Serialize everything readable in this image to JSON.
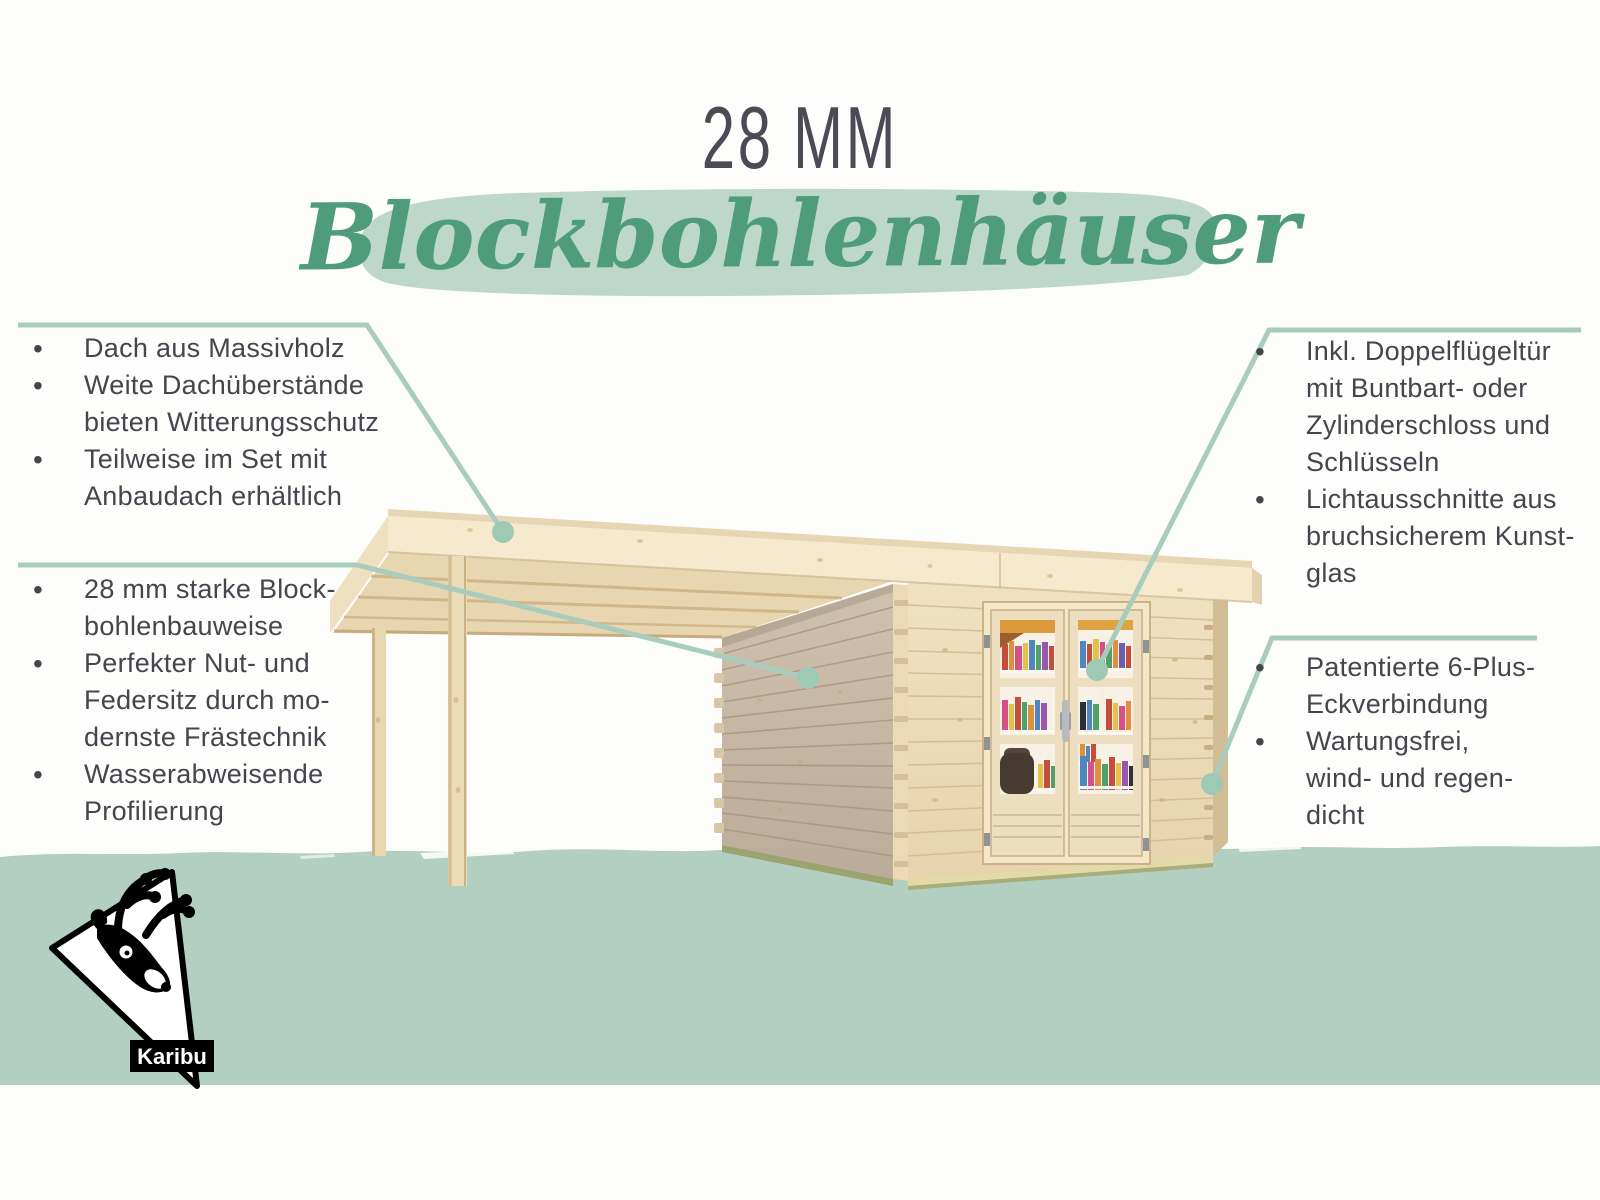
{
  "header": {
    "size_label": "28 MM",
    "title": "Blockbohlenhäuser"
  },
  "features": {
    "left_top": {
      "items": [
        {
          "lines": [
            "Dach aus Massivholz"
          ]
        },
        {
          "lines": [
            "Weite Dachüberstände",
            "bieten Witterungsschutz"
          ]
        },
        {
          "lines": [
            "Teilweise im Set mit",
            "Anbaudach erhältlich"
          ]
        }
      ]
    },
    "left_bottom": {
      "items": [
        {
          "lines": [
            "28 mm starke Block-",
            "bohlenbauweise"
          ]
        },
        {
          "lines": [
            "Perfekter Nut- und",
            "Federsitz durch mo-",
            "dernste Frästechnik"
          ]
        },
        {
          "lines": [
            "Wasserabweisende",
            "Profilierung"
          ]
        }
      ]
    },
    "right_top": {
      "items": [
        {
          "lines": [
            "Inkl. Doppelflügeltür",
            "mit Buntbart- oder",
            "Zylinderschloss und",
            "Schlüsseln"
          ]
        },
        {
          "lines": [
            "Lichtausschnitte aus",
            "bruchsicherem Kunst-",
            "glas"
          ]
        }
      ]
    },
    "right_bottom": {
      "items": [
        {
          "lines": [
            "Patentierte 6-Plus-",
            "Eckverbindung"
          ]
        },
        {
          "lines": [
            "Wartungsfrei,",
            "wind- und regen-",
            "dicht"
          ]
        }
      ]
    }
  },
  "logo": {
    "brand": "Karibu"
  },
  "colors": {
    "accent_green": "#4f9c7d",
    "brush_mint": "#bdd8ca",
    "ground_mint": "#b3cfc1",
    "callout_line": "#a9cdbd",
    "text": "#45454d",
    "roof_cream": "#f6e9cd",
    "wall_front": "#eddcb8",
    "wall_side": "#c6b5a2"
  }
}
